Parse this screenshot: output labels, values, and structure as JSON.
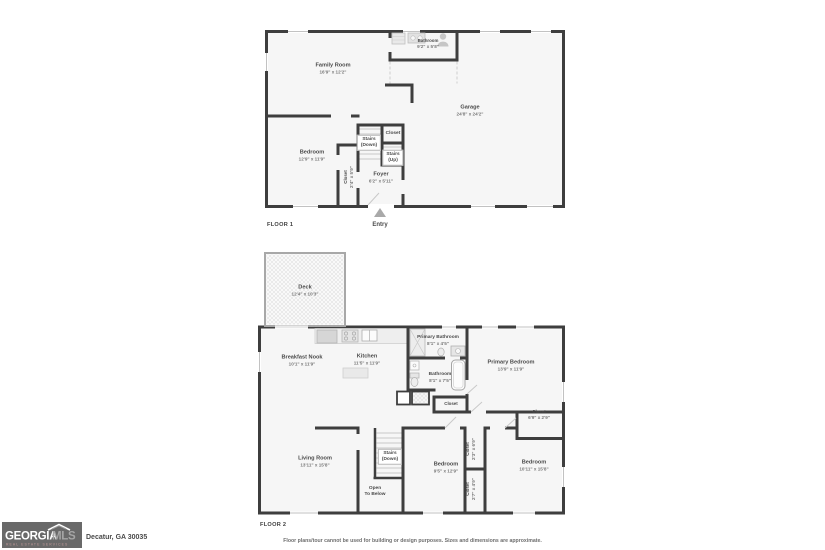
{
  "floor1": {
    "title": "FLOOR 1",
    "entry_label": "Entry",
    "icons": [
      "entry-arrow-icon",
      "person-icon",
      "shower-icon",
      "vanity-icon",
      "stair-treads"
    ],
    "rooms": {
      "family_room": {
        "name": "Family Room",
        "dims": "16'9\" x 12'2\""
      },
      "bathroom": {
        "name": "Bathroom",
        "dims": "9'2\" x 5'8\""
      },
      "garage": {
        "name": "Garage",
        "dims": "24'8\" x 24'2\""
      },
      "bedroom": {
        "name": "Bedroom",
        "dims": "12'9\" x 11'9\""
      },
      "stairs_down": {
        "name": "Stairs",
        "sub": "(Down)"
      },
      "closet_hall": {
        "name": "Closet"
      },
      "stairs_up": {
        "name": "Stairs",
        "sub": "(Up)"
      },
      "closet_bedroom": {
        "name": "Closet",
        "dims": "2'4\" x 5'9\""
      },
      "foyer": {
        "name": "Foyer",
        "dims": "6'2\" x 5'11\""
      }
    }
  },
  "floor2": {
    "title": "FLOOR 2",
    "icons": [
      "deck-hatch",
      "fridge-icon",
      "stove-icon",
      "sink-icon",
      "tub-icon",
      "toilet-icon",
      "shower-icon",
      "stair-treads"
    ],
    "rooms": {
      "deck": {
        "name": "Deck",
        "dims": "12'4\" x 10'3\""
      },
      "breakfast_nook": {
        "name": "Breakfast Nook",
        "dims": "10'1\" x 11'9\""
      },
      "kitchen": {
        "name": "Kitchen",
        "dims": "11'5\" x 11'9\""
      },
      "primary_bathroom": {
        "name": "Primary Bathroom",
        "dims": "8'1\" x 4'5\""
      },
      "primary_bedroom": {
        "name": "Primary Bedroom",
        "dims": "13'9\" x 11'9\""
      },
      "bathroom": {
        "name": "Bathroom",
        "dims": "8'1\" x 7'5\""
      },
      "closet_bath": {
        "name": "Closet"
      },
      "closet_primary": {
        "name": "Closet",
        "dims": "6'9\" x 2'9\""
      },
      "living_room": {
        "name": "Living Room",
        "dims": "13'11\" x 15'8\""
      },
      "stairs_down": {
        "name": "Stairs",
        "sub": "(Down)"
      },
      "open_below": {
        "name": "Open",
        "sub": "To Below"
      },
      "bedroom_mid": {
        "name": "Bedroom",
        "dims": "9'5\" x 12'9\""
      },
      "closet_mid_top": {
        "name": "Closet",
        "dims": "2'3\" x 6'9\""
      },
      "closet_mid_bottom": {
        "name": "Closet",
        "dims": "2'7\" x 4'9\""
      },
      "bedroom_right": {
        "name": "Bedroom",
        "dims": "10'11\" x 15'8\""
      }
    }
  },
  "footer": {
    "logo": {
      "line1": "GEORGIA",
      "line2": "MLS",
      "tagline": "REAL ESTATE SERVICES"
    },
    "address": "Decatur, GA 30035",
    "disclaimer": "Floor plans/tour cannot be used for building or design purposes. Sizes and dimensions are approximate."
  },
  "colors": {
    "wall": "#3e3e3e",
    "room_fill": "#f6f6f6",
    "label": "#4a4a4a",
    "window": "#c2c2c2",
    "fixture": "#e8e8e8",
    "logo_bg": "#696969"
  }
}
